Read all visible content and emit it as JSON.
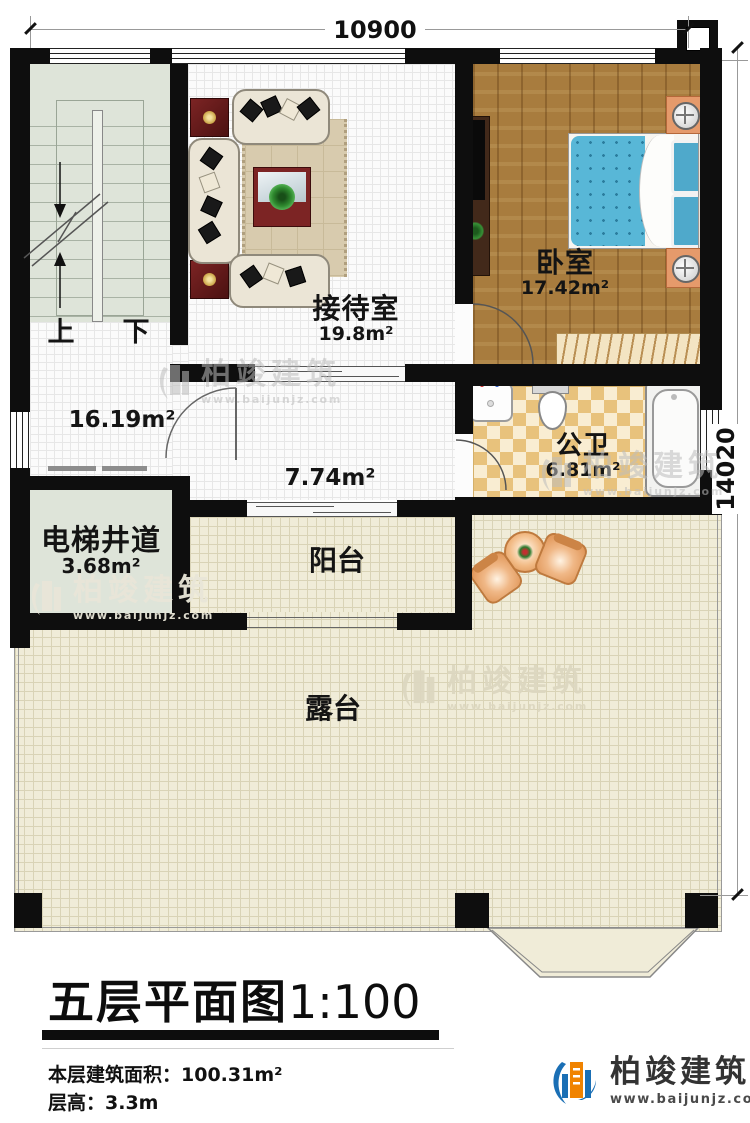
{
  "dimensions": {
    "width": "10900",
    "height": "14020"
  },
  "title": {
    "text": "五层平面图",
    "scale": "1:100"
  },
  "info": {
    "area_label": "本层建筑面积：",
    "area_value": "100.31m²",
    "height_label": "层高：",
    "height_value": "3.3m"
  },
  "brand": {
    "name": "柏竣建筑",
    "site": "www.baijunjz.com"
  },
  "rooms": {
    "stairs": {
      "up": "上",
      "down": "下"
    },
    "hall": {
      "area": "16.19m²"
    },
    "reception": {
      "name": "接待室",
      "area": "19.8m²"
    },
    "bedroom": {
      "name": "卧室",
      "area": "17.42m²"
    },
    "bathroom": {
      "name": "公卫",
      "area": "6.81m²"
    },
    "elevator": {
      "name": "电梯井道",
      "area": "3.68m²"
    },
    "corridor": {
      "area": "7.74m²"
    },
    "balcony": {
      "name": "阳台"
    },
    "terrace": {
      "name": "露台"
    }
  },
  "colors": {
    "wall": "#0e0e0e",
    "wood_floor": "#a87c3e",
    "mattress_blue": "#58b7d7",
    "terrace_beige": "#f0ecd8",
    "bath_checker": "#e8c27c",
    "stair_sage": "#dee4d9",
    "brand_blue": "#1a6fb5",
    "brand_orange": "#f08300"
  }
}
